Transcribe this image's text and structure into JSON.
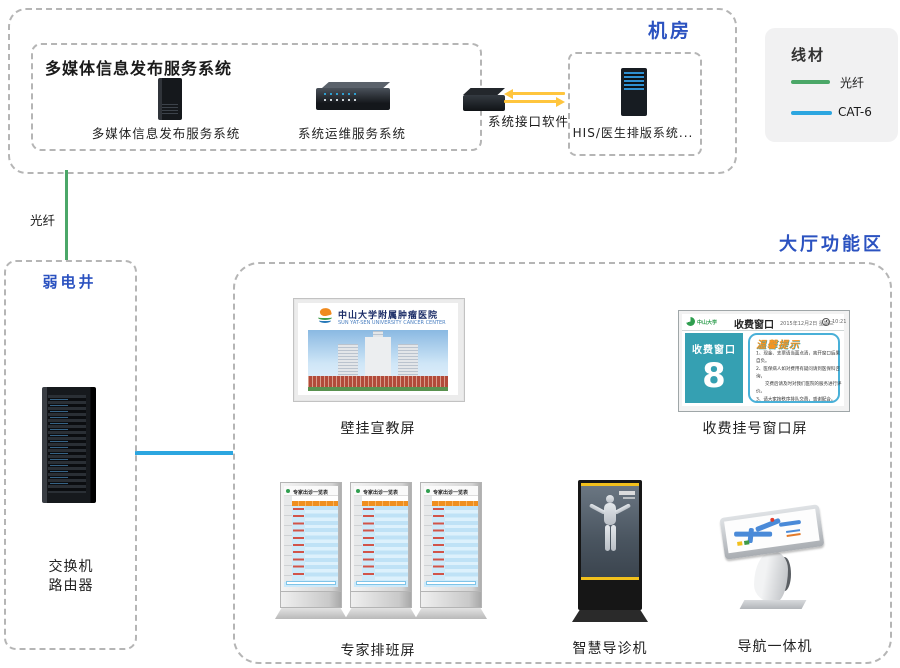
{
  "machine_room": {
    "title": "机房",
    "publish_box": {
      "title": "多媒体信息发布服务系统",
      "server1_label": "多媒体信息发布服务系统",
      "server2_label": "系统运维服务系统"
    },
    "interface_device": {
      "label": "系统接口软件"
    },
    "his_box": {
      "label": "HIS/医生排版系统..."
    }
  },
  "legend": {
    "title": "线材",
    "fiber_label": "光纤",
    "cat6_label": "CAT-6",
    "fiber_color": "#4ba768",
    "cat6_color": "#2ca6e0"
  },
  "fiber_link_label": "光纤",
  "weak_well": {
    "title": "弱电井",
    "rack_label_line1": "交换机",
    "rack_label_line2": "路由器"
  },
  "hall": {
    "title": "大厅功能区",
    "wall_screen": {
      "caption": "壁挂宣教屏",
      "hospital_name_cn": "中山大学附属肿瘤医院",
      "hospital_name_en": "SUN YAT-SEN UNIVERSITY CANCER CENTER"
    },
    "fee_screen": {
      "caption": "收费挂号窗口屏",
      "logo_text": "中山大学",
      "header_title": "收费窗口",
      "date_text": "2015年12月2日 星期三",
      "time_text": "10:21",
      "panel_title": "收费窗口",
      "window_number": "8",
      "tips_title": "温馨提示",
      "tips_line1": "1、现金、支票请当面点清，离开窗口后果自负。",
      "tips_line2": "2、医保病人如对费用有疑问请到医保科咨询，",
      "tips_line3": "　　交费后请及时对我们医院的服务进行评价。",
      "tips_line4": "3、请大家按秩序排队交费，感谢配合。"
    },
    "schedule_kiosk": {
      "caption": "专家排班屏",
      "screen_title": "专家出诊一览表"
    },
    "guide_kiosk": {
      "caption": "智慧导诊机"
    },
    "nav_kiosk": {
      "caption": "导航一体机"
    }
  }
}
